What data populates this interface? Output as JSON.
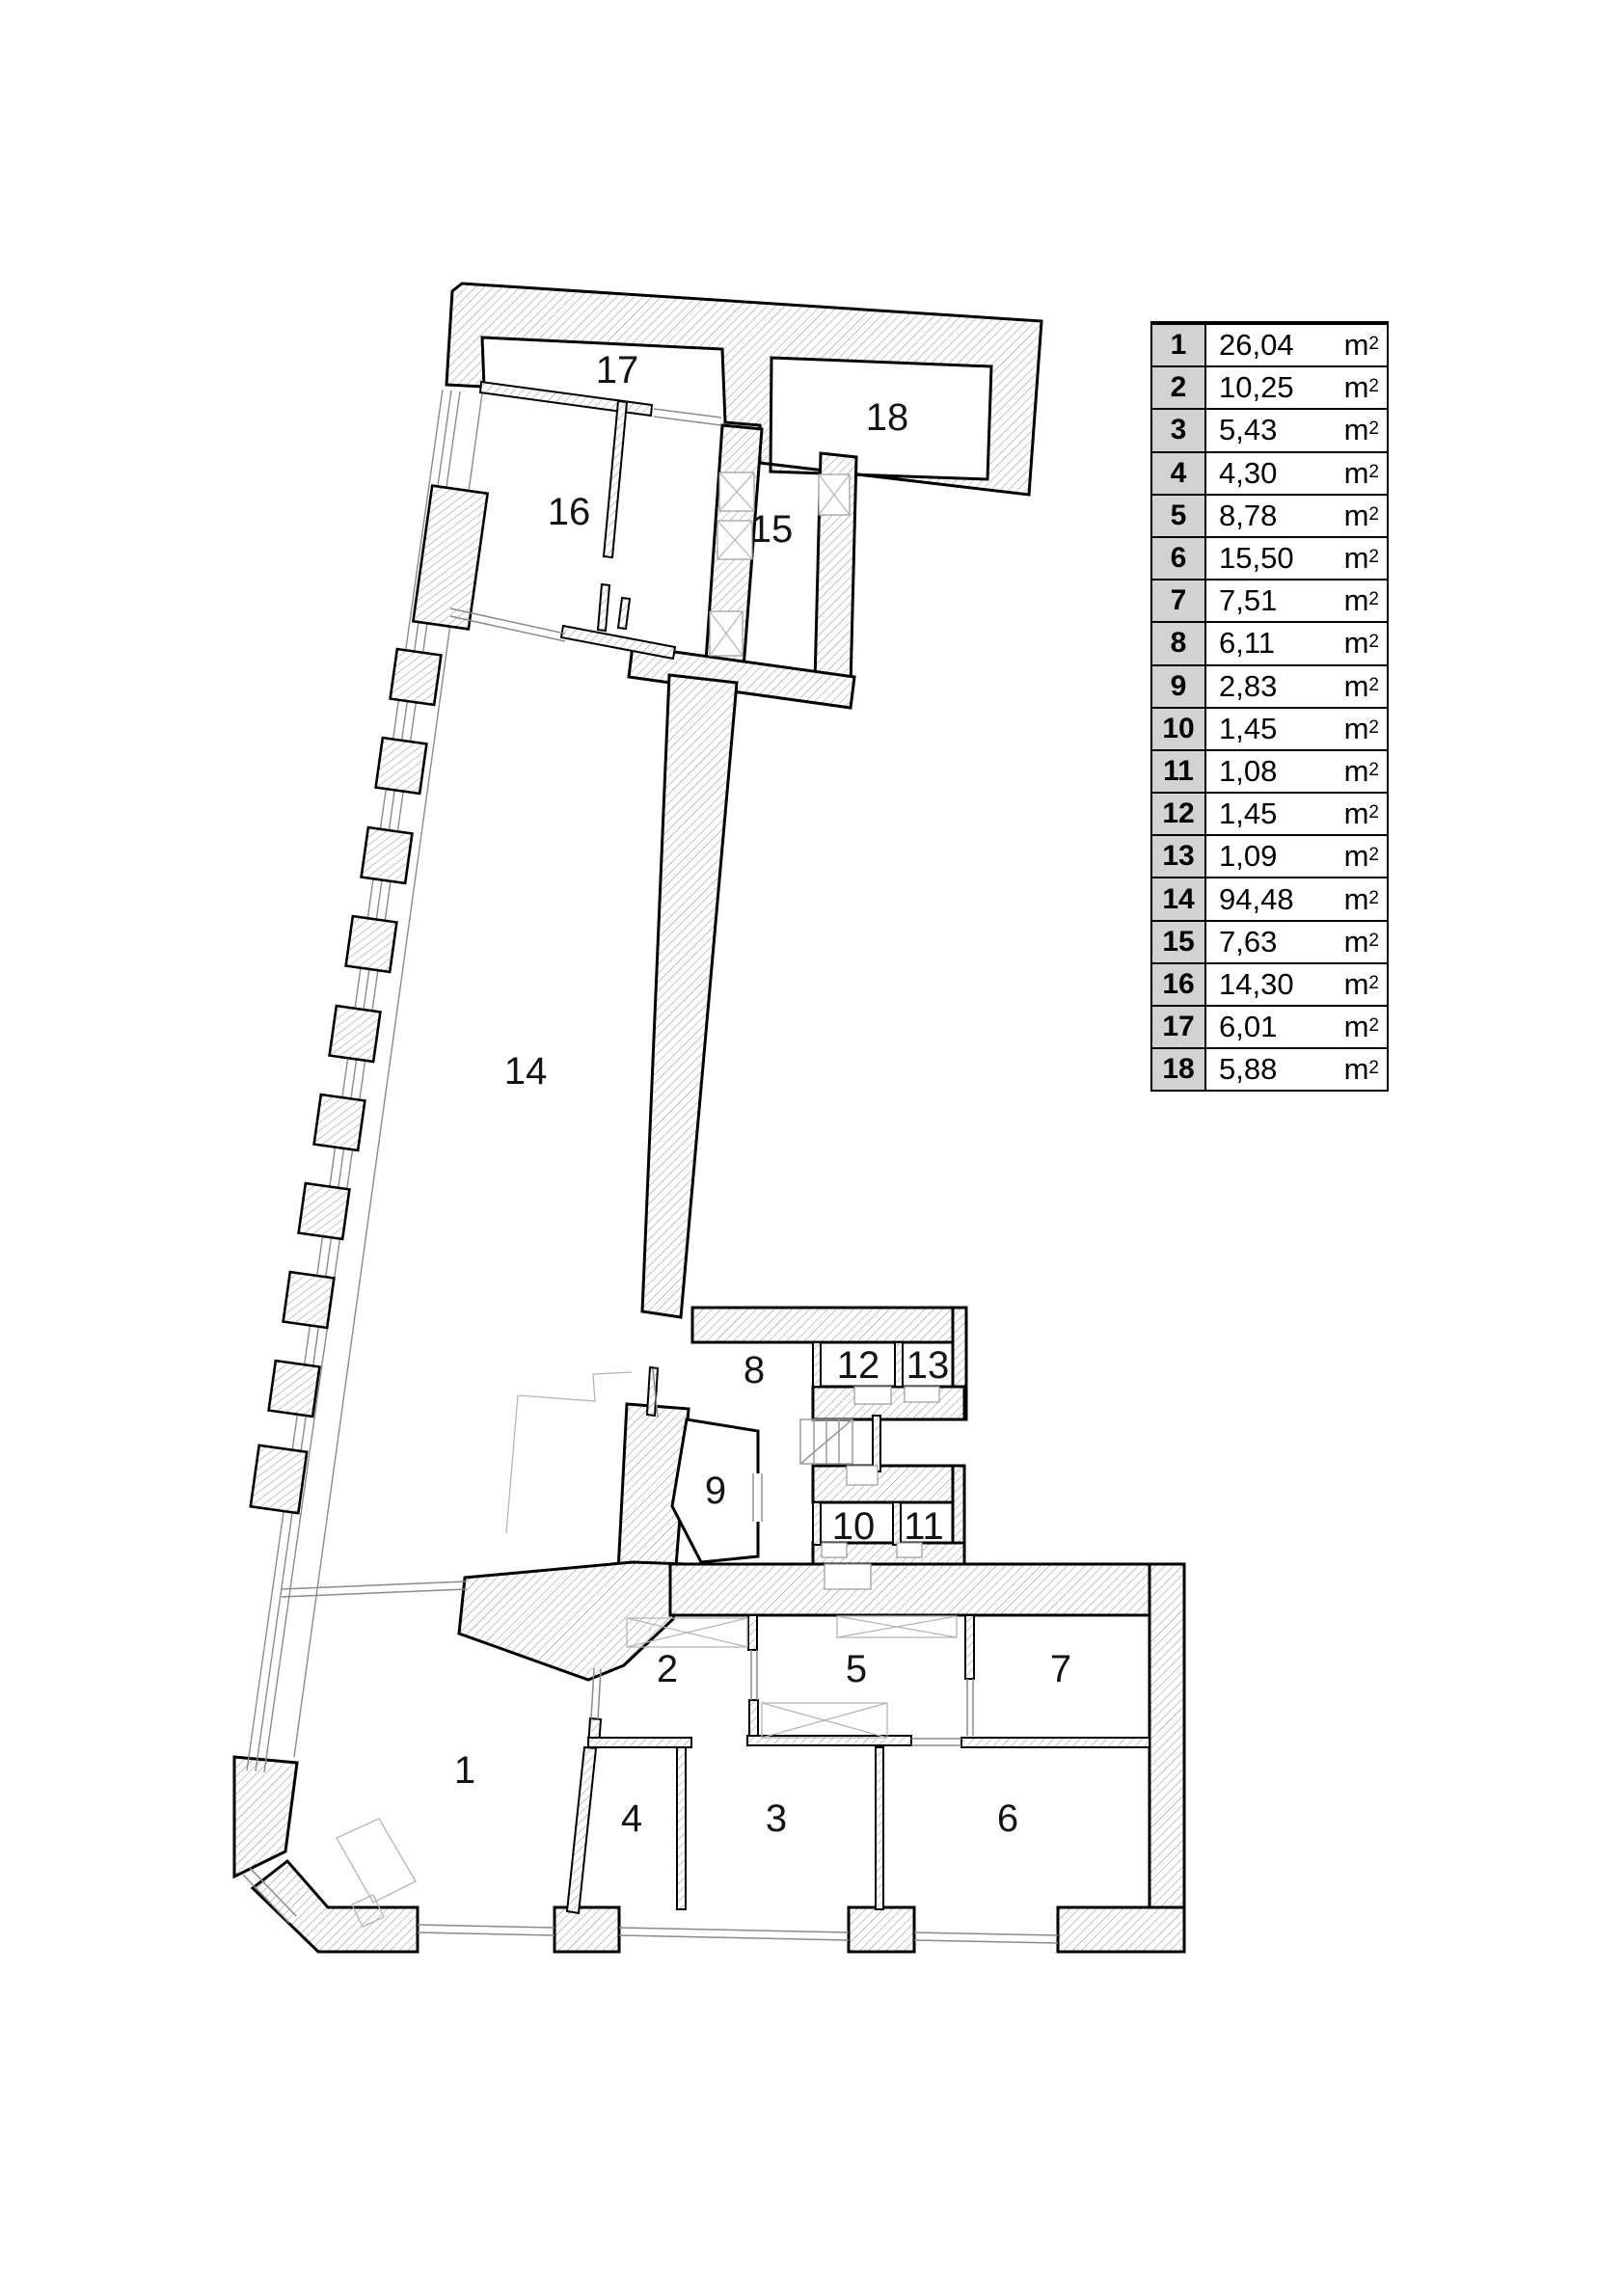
{
  "legend": {
    "unit_base": "m",
    "unit_sup": "2",
    "rows": [
      {
        "num": "1",
        "value": "26,04"
      },
      {
        "num": "2",
        "value": "10,25"
      },
      {
        "num": "3",
        "value": "5,43"
      },
      {
        "num": "4",
        "value": "4,30"
      },
      {
        "num": "5",
        "value": "8,78"
      },
      {
        "num": "6",
        "value": "15,50"
      },
      {
        "num": "7",
        "value": "7,51"
      },
      {
        "num": "8",
        "value": "6,11"
      },
      {
        "num": "9",
        "value": "2,83"
      },
      {
        "num": "10",
        "value": "1,45"
      },
      {
        "num": "11",
        "value": "1,08"
      },
      {
        "num": "12",
        "value": "1,45"
      },
      {
        "num": "13",
        "value": "1,09"
      },
      {
        "num": "14",
        "value": "94,48"
      },
      {
        "num": "15",
        "value": "7,63"
      },
      {
        "num": "16",
        "value": "14,30"
      },
      {
        "num": "17",
        "value": "6,01"
      },
      {
        "num": "18",
        "value": "5,88"
      }
    ]
  },
  "plan": {
    "rooms": [
      {
        "label": "1"
      },
      {
        "label": "2"
      },
      {
        "label": "3"
      },
      {
        "label": "4"
      },
      {
        "label": "5"
      },
      {
        "label": "6"
      },
      {
        "label": "7"
      },
      {
        "label": "8"
      },
      {
        "label": "9"
      },
      {
        "label": "10"
      },
      {
        "label": "11"
      },
      {
        "label": "12"
      },
      {
        "label": "13"
      },
      {
        "label": "14"
      },
      {
        "label": "15"
      },
      {
        "label": "16"
      },
      {
        "label": "17"
      },
      {
        "label": "18"
      }
    ]
  },
  "colors": {
    "wall_outline": "#000000",
    "hatch_line": "#8a8a8a",
    "legend_number_bg": "#d2d2d2",
    "detail_gray": "#b5b5b5"
  }
}
